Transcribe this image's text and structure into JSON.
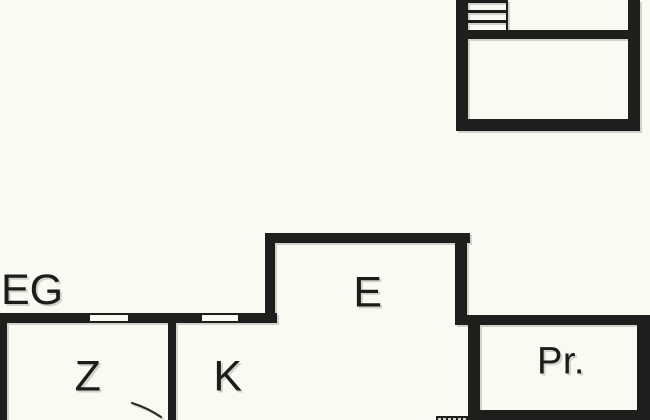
{
  "colors": {
    "background": "#faf9f2",
    "wall": "#1e1e1c",
    "text": "#1c1c1a"
  },
  "upper_unit": {
    "description": "detached upper-floor plan fragment, cropped at top",
    "elements": [
      "staircase"
    ]
  },
  "plan": {
    "floor_label": "EG",
    "rooms": [
      {
        "label": "Z"
      },
      {
        "label": "K"
      },
      {
        "label": "E"
      },
      {
        "label": "Pr."
      }
    ],
    "features": [
      "window",
      "window",
      "staircase",
      "door-swing-arc"
    ]
  }
}
